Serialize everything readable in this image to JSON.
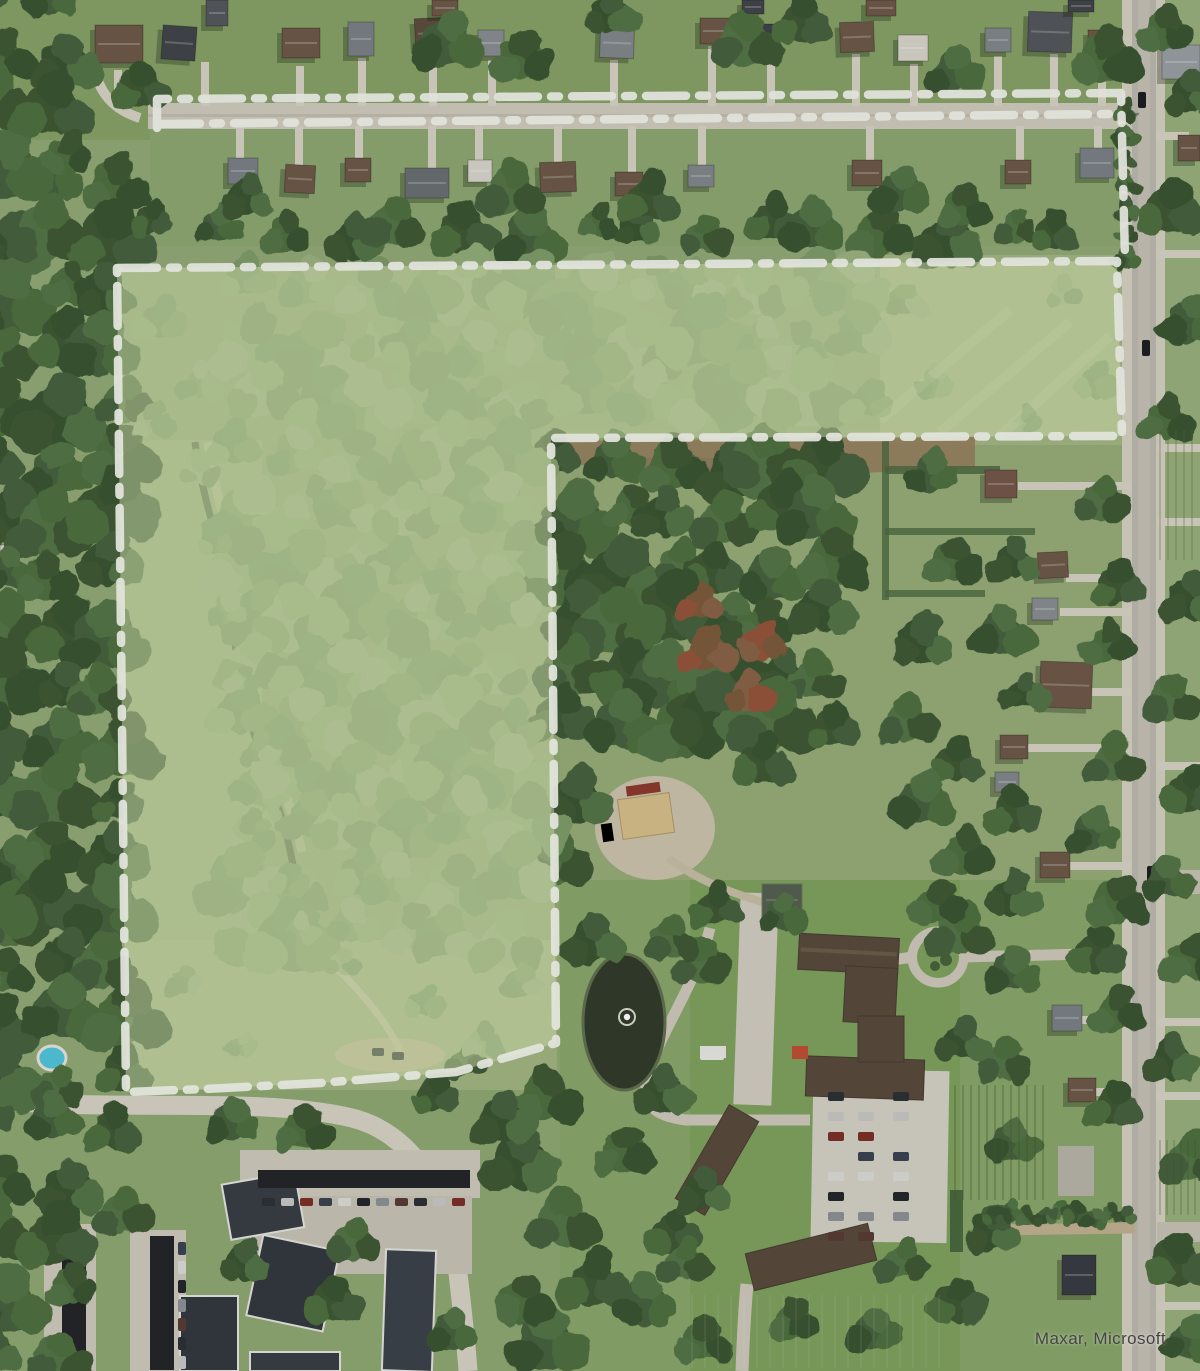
{
  "map": {
    "attribution": "Maxar, Microsoft",
    "overlay": {
      "fill_color": "#cde39b",
      "stroke_color": "#f3f5ec"
    }
  }
}
